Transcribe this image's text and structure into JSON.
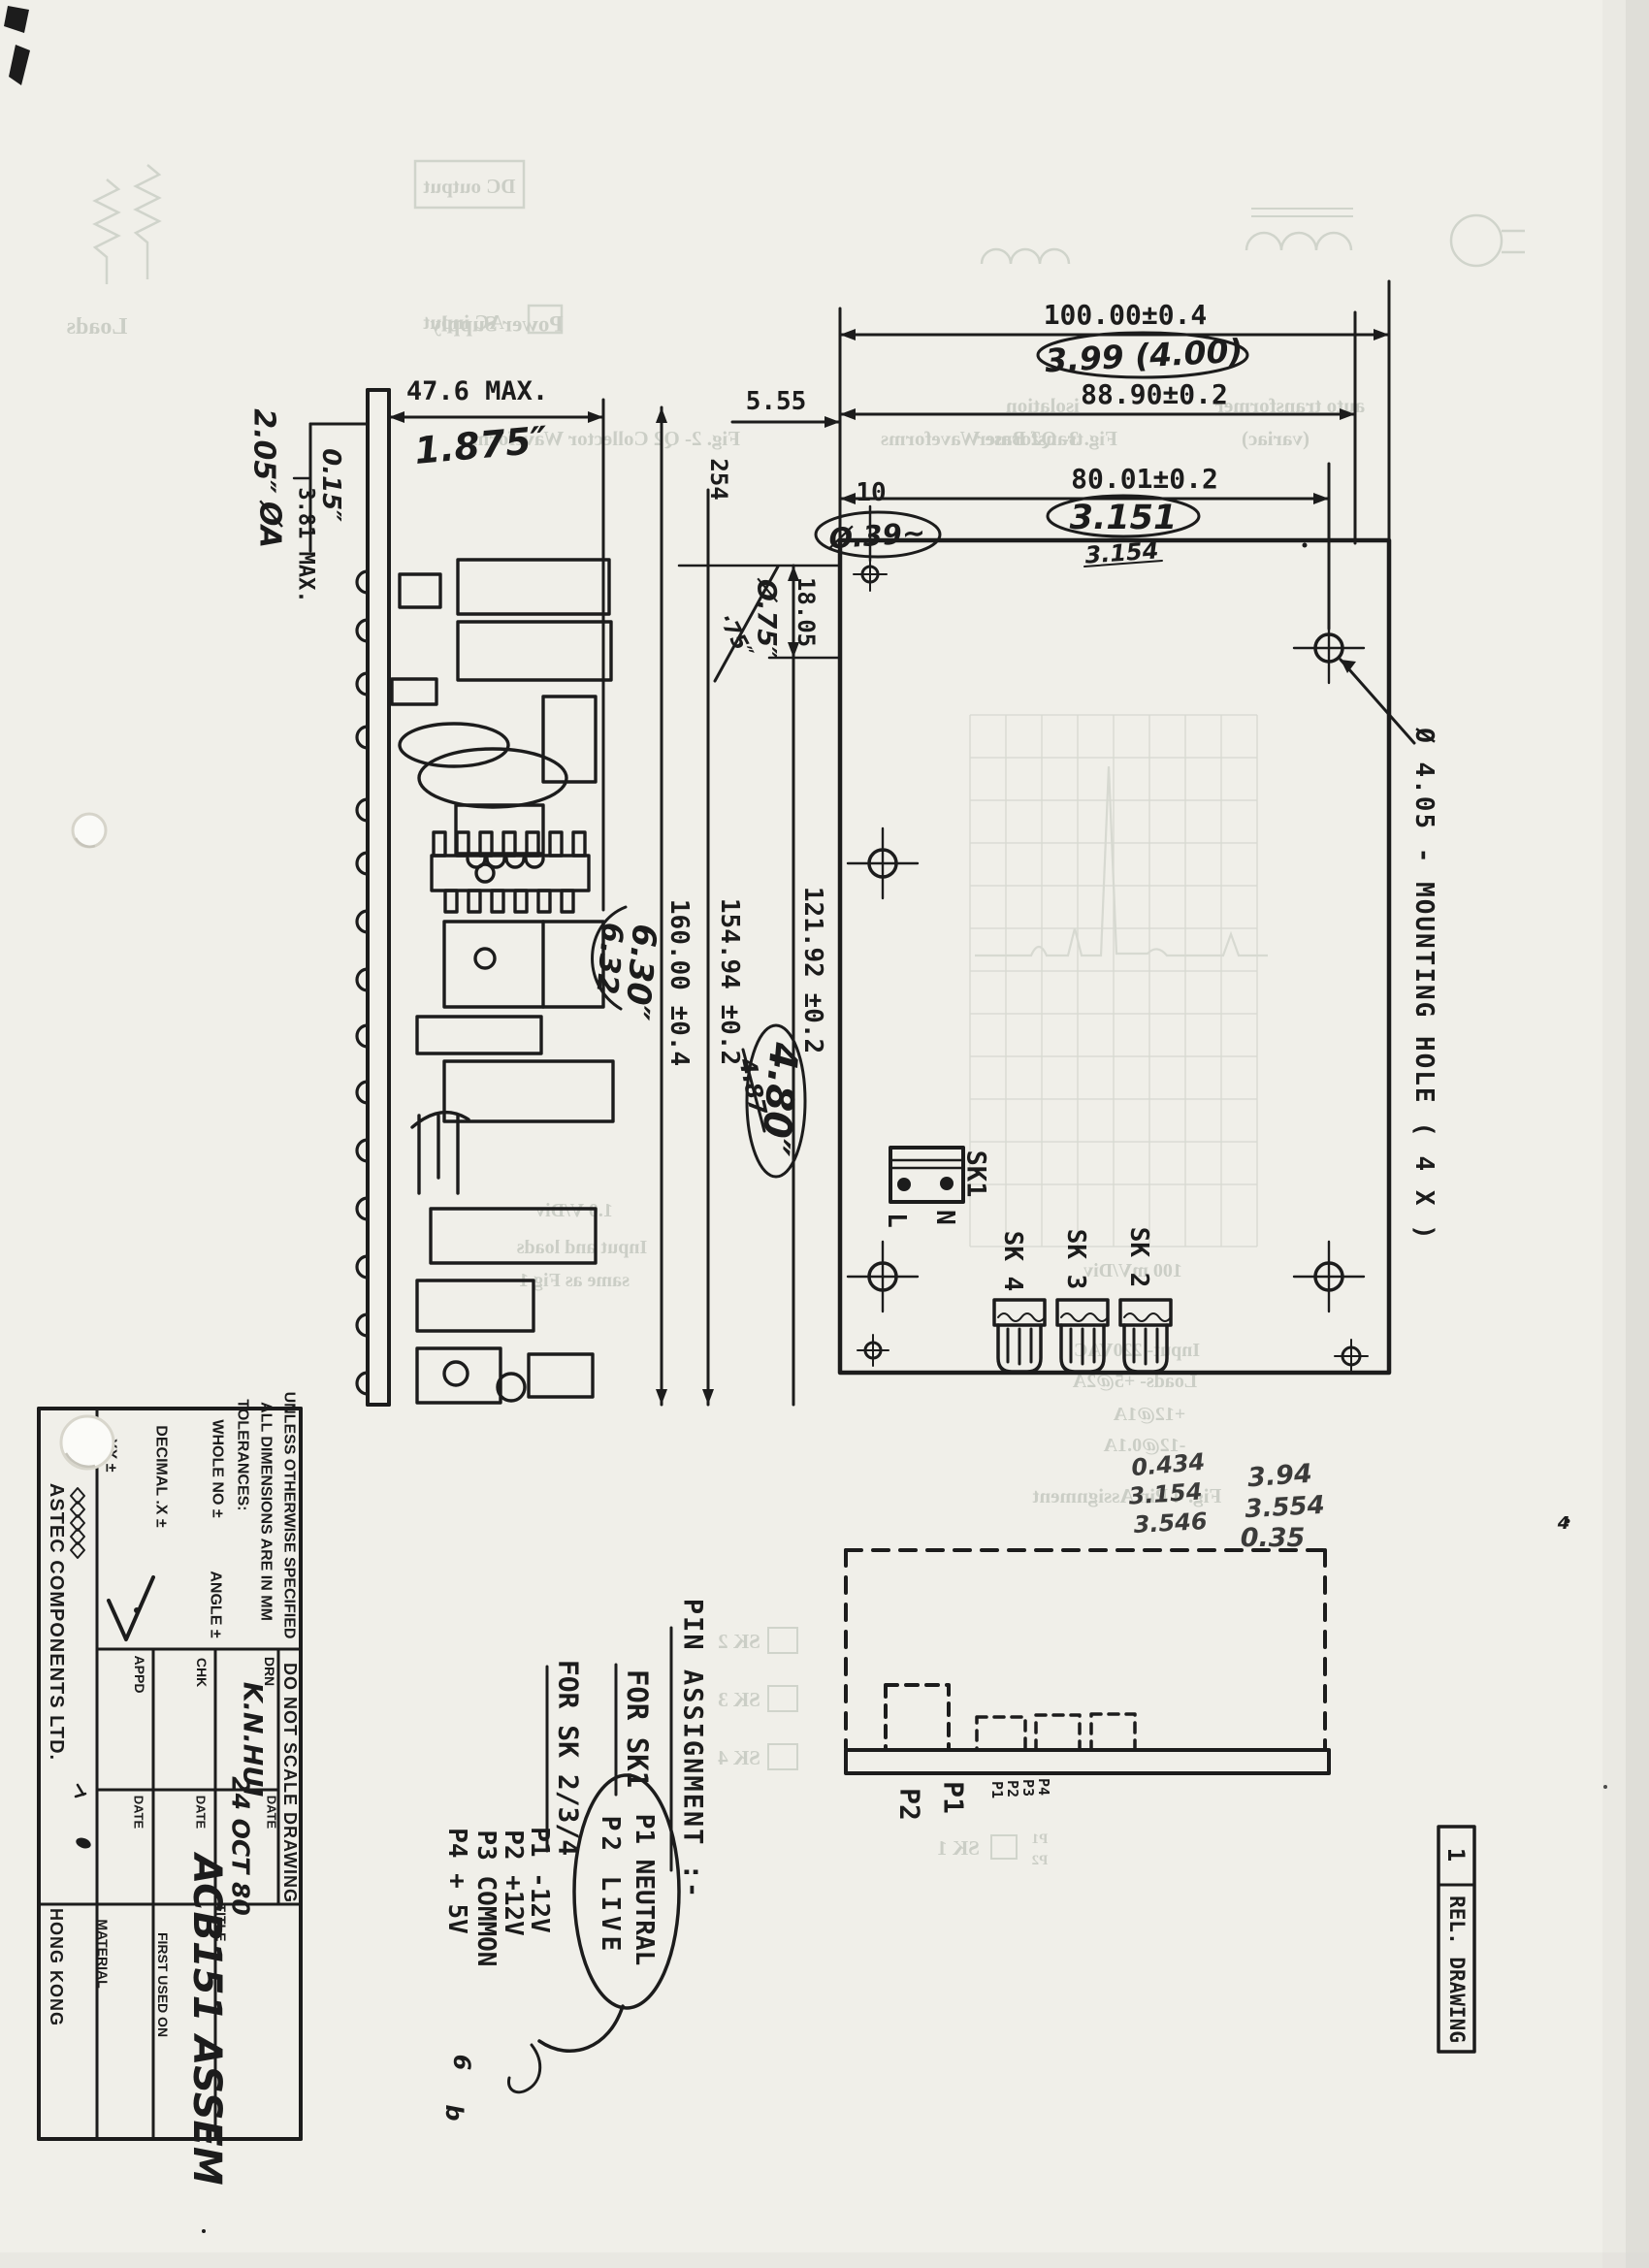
{
  "plan_view": {
    "dims": {
      "d100": "100.00±0.4",
      "d88": "88.90±0.2",
      "d80": "80.01±0.2",
      "d555": "5.55",
      "d10": "10",
      "d254": "254",
      "d1805": "18.05",
      "d12192": "121.92 ±0.2",
      "d15494": "154.94 ±0.2",
      "d16000": "160.00 ±0.4"
    },
    "handwritten": {
      "hw399": "3.99 (4.00)",
      "hw3151": "3.151",
      "hw3154": "3.154",
      "hw039": "Ø.39~",
      "hw075": "Ø.75″",
      "hw075b": "·75″",
      "hw480": "4.80″",
      "hw487": "4.87",
      "hw630": "6.30″",
      "hw632": "6.32",
      "stray4": "4"
    },
    "labels": {
      "sk1": "SK1",
      "l": "L",
      "n": "N",
      "sk2": "SK 2",
      "sk3": "SK 3",
      "sk4": "SK 4",
      "mounting_note": "Ø 4.05 - MOUNTING HOLE ( 4 X )"
    },
    "hw_numbers_left": [
      "0.434",
      "3.154",
      "3.546"
    ],
    "hw_numbers_right": [
      "3.94",
      "3.554",
      "0.35"
    ]
  },
  "elevation": {
    "dims": {
      "d476": "47.6 MAX.",
      "d381": "3.81 MAX."
    },
    "handwritten": {
      "hw1875": "1.875″",
      "hw015": "0.15″",
      "hw205": "2.05″",
      "hwdia": "ØA"
    }
  },
  "side_view": {
    "p1": "P1",
    "p2": "P2",
    "pins_small": [
      "P1",
      "P2",
      "P3",
      "P4"
    ]
  },
  "pin_assignment": {
    "heading": "PIN ASSIGNMENT :-",
    "sk1_heading": "FOR SK1",
    "sk1_pins": [
      "P1 NEUTRAL",
      "P2 LIVE"
    ],
    "sk234_heading": "FOR SK 2/3/4",
    "sk234_pins": [
      "P1  -12V",
      "P2  +12V",
      "P3  COMMON",
      "P4  + 5V"
    ],
    "scribble_6": "6",
    "scribble_b": "b"
  },
  "title_block": {
    "spec_line1": "UNLESS OTHERWISE SPECIFIED",
    "spec_line2": "ALL DIMENSIONS ARE IN MM",
    "spec_line3": "TOLERANCES:",
    "tol_whole": "WHOLE NO  ±",
    "tol_angle": "ANGLE  ±",
    "tol_decimal": "DECIMAL  .X ±",
    "tol_decimal2": ".XX ±",
    "do_not_scale": "DO NOT SCALE DRAWING",
    "drn_label": "DRN",
    "drn_value": "K.N.HUI",
    "date_label": "DATE",
    "date_value": "24 OCT 80",
    "chk_label": "CHK",
    "appd_label": "APPD",
    "title_label": "TITLE",
    "title_value": "ACB151 ASSEM",
    "first_used_label": "FIRST USED ON",
    "material_label": "MATERIAL",
    "company": "ASTEC COMPONENTS LTD.",
    "location": "HONG KONG"
  },
  "revision": {
    "number": "1",
    "label": "REL. DRAWING"
  },
  "ghost": {
    "loads": "Loads",
    "dc_output": "DC output",
    "ac_input": "AC input",
    "power_supply": "Power Supply",
    "fig2": "Fig. 2- Q2 Collector Waveform",
    "fig3": "Fig. 3- Q2 Base Waveforms",
    "isolation": "isolation",
    "transformer": "transformer",
    "auto_transformer": "auto transformer",
    "variac": "(variac)",
    "scope1": "1.0 V/Div",
    "scope2": "Input and loads",
    "scope3": "same as Fig 1",
    "r1": "100 mV/Div",
    "r2": "Input- 220VAC",
    "r3": "Loads- +5@2A",
    "r4": "+12@1A",
    "r5": "-12@0.1A",
    "fig4": "Fig. 4 Pin Assignment",
    "gsk2": "SK 2",
    "gsk3": "SK 3",
    "gsk4": "SK 4",
    "gsk1": "SK 1",
    "gp1": "P1",
    "gp2": "P2"
  },
  "colors": {
    "paper": "#f0efe9",
    "ink": "#1c1c1c",
    "ghost": "#adb3a9"
  }
}
